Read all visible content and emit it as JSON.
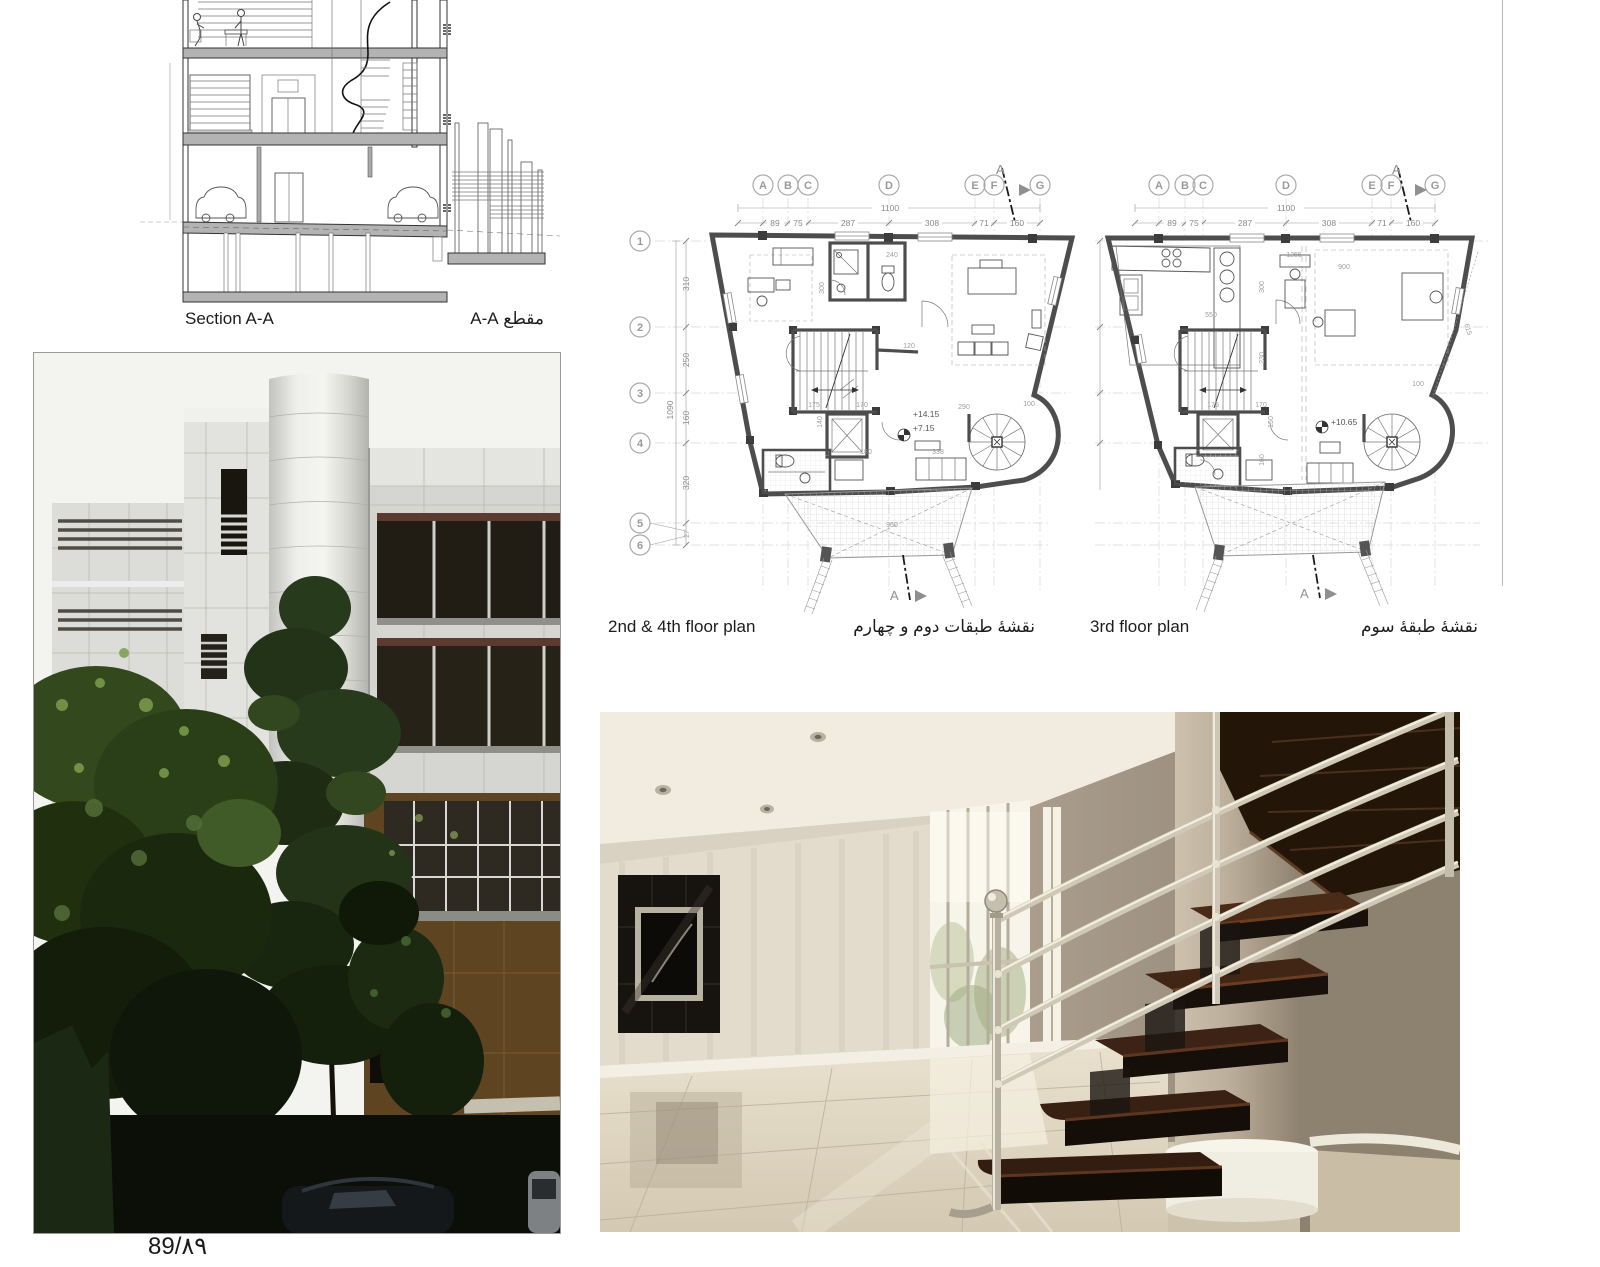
{
  "page": {
    "page_number": "89/۸۹"
  },
  "section_drawing": {
    "label_en": "Section A-A",
    "label_fa": "مقطع A-A"
  },
  "floor_plans": {
    "grid_columns": [
      "A",
      "B",
      "C",
      "D",
      "E",
      "F",
      "G"
    ],
    "grid_rows": [
      "1",
      "2",
      "3",
      "4",
      "5",
      "6"
    ],
    "top_total_dim": "1100",
    "top_dims": [
      "89",
      "75",
      "287",
      "308",
      "71",
      "160"
    ],
    "left_total_dim": "1090",
    "left_dims": [
      "310",
      "250",
      "160",
      "320"
    ],
    "left_small_dim": "27",
    "section_marker": "A",
    "left_plan": {
      "label_en": "2nd & 4th floor plan",
      "label_fa": "نقشهٔ طبقات دوم و چهارم",
      "elevation_upper": "+14.15",
      "elevation_lower": "+7.15",
      "dims": [
        "240",
        "300",
        "120",
        "175",
        "170",
        "140",
        "180",
        "338",
        "290",
        "100",
        "960"
      ]
    },
    "right_plan": {
      "label_en": "3rd floor plan",
      "label_fa": "نقشهٔ طبقهٔ سوم",
      "elevation": "+10.65",
      "dims": [
        "1255",
        "900",
        "550",
        "300",
        "230",
        "175",
        "170",
        "150",
        "160",
        "100",
        "615"
      ]
    }
  }
}
